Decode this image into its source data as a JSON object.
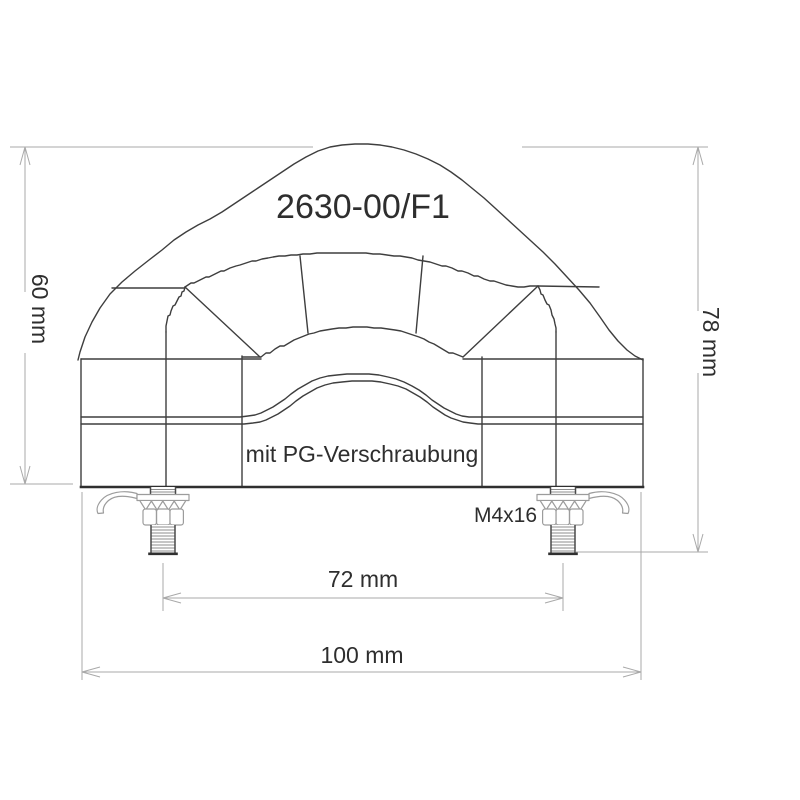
{
  "drawing": {
    "part_number": "2630-00/F1",
    "variant_note": "mit PG-Verschraubung",
    "screw_label": "M4x16",
    "dimensions": {
      "body_height": "60 mm",
      "total_height": "78 mm",
      "bolt_spacing": "72 mm",
      "total_width": "100 mm"
    },
    "colors": {
      "line": "#3e3e3e",
      "dimension_line": "#a9a9a9",
      "text": "#2e2e2e",
      "hardware": "#9c9c9c",
      "background": "#ffffff"
    }
  }
}
